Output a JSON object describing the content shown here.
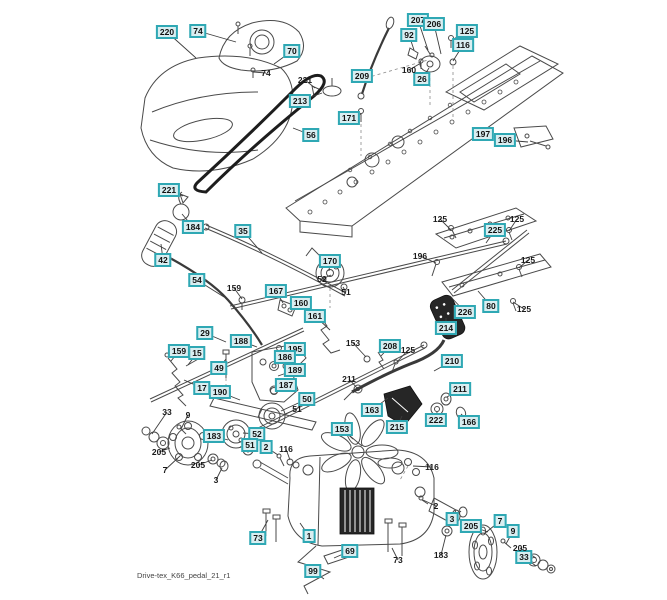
{
  "footer": {
    "filename": "Drive-tex_K66_pedal_21_r1"
  },
  "colors": {
    "callout_border": "#2fa8b4",
    "callout_fill": "#d9eef1",
    "leader_line": "#3d3d3d",
    "line_art": "#4a4a4a",
    "background": "#ffffff"
  },
  "callouts": [
    {
      "label": "220",
      "x": 167,
      "y": 32,
      "boxed": true,
      "tx": 196,
      "ty": 58
    },
    {
      "label": "74",
      "x": 198,
      "y": 31,
      "boxed": true,
      "tx": 236,
      "ty": 42
    },
    {
      "label": "70",
      "x": 292,
      "y": 51,
      "boxed": true,
      "tx": 274,
      "ty": 64
    },
    {
      "label": "213",
      "x": 300,
      "y": 101,
      "boxed": true,
      "tx": 322,
      "ty": 93
    },
    {
      "label": "207",
      "x": 418,
      "y": 20,
      "boxed": true,
      "tx": 428,
      "ty": 50
    },
    {
      "label": "206",
      "x": 434,
      "y": 24,
      "boxed": true,
      "tx": 441,
      "ty": 54
    },
    {
      "label": "92",
      "x": 409,
      "y": 35,
      "boxed": true,
      "tx": 414,
      "ty": 50
    },
    {
      "label": "125",
      "x": 467,
      "y": 31,
      "boxed": true,
      "tx": 452,
      "ty": 40
    },
    {
      "label": "116",
      "x": 463,
      "y": 45,
      "boxed": true,
      "tx": 453,
      "ty": 61
    },
    {
      "label": "209",
      "x": 362,
      "y": 76,
      "boxed": true,
      "tx": 370,
      "ty": 72
    },
    {
      "label": "26",
      "x": 422,
      "y": 79,
      "boxed": true,
      "tx": 429,
      "ty": 68
    },
    {
      "label": "171",
      "x": 349,
      "y": 118,
      "boxed": true,
      "tx": 361,
      "ty": 114
    },
    {
      "label": "56",
      "x": 311,
      "y": 135,
      "boxed": true,
      "tx": 293,
      "ty": 128
    },
    {
      "label": "197",
      "x": 483,
      "y": 134,
      "boxed": true,
      "tx": 514,
      "ty": 134
    },
    {
      "label": "196",
      "x": 505,
      "y": 140,
      "boxed": true,
      "tx": 528,
      "ty": 142
    },
    {
      "label": "221",
      "x": 169,
      "y": 190,
      "boxed": true,
      "tx": 183,
      "ty": 196
    },
    {
      "label": "184",
      "x": 193,
      "y": 227,
      "boxed": true,
      "tx": 182,
      "ty": 214
    },
    {
      "label": "35",
      "x": 243,
      "y": 231,
      "boxed": true,
      "tx": 262,
      "ty": 253
    },
    {
      "label": "42",
      "x": 163,
      "y": 260,
      "boxed": true,
      "tx": 161,
      "ty": 244
    },
    {
      "label": "54",
      "x": 197,
      "y": 280,
      "boxed": true,
      "tx": 224,
      "ty": 297
    },
    {
      "label": "167",
      "x": 276,
      "y": 291,
      "boxed": true,
      "tx": 283,
      "ty": 303
    },
    {
      "label": "160",
      "x": 301,
      "y": 303,
      "boxed": true,
      "tx": 315,
      "ty": 314
    },
    {
      "label": "161",
      "x": 315,
      "y": 316,
      "boxed": true,
      "tx": 330,
      "ty": 330
    },
    {
      "label": "170",
      "x": 330,
      "y": 261,
      "boxed": true,
      "tx": 329,
      "ty": 271
    },
    {
      "label": "225",
      "x": 495,
      "y": 230,
      "boxed": true,
      "tx": 486,
      "ty": 243
    },
    {
      "label": "80",
      "x": 491,
      "y": 306,
      "boxed": true,
      "tx": 478,
      "ty": 291
    },
    {
      "label": "226",
      "x": 465,
      "y": 312,
      "boxed": true,
      "tx": 450,
      "ty": 296
    },
    {
      "label": "29",
      "x": 205,
      "y": 333,
      "boxed": true,
      "tx": 226,
      "ty": 342
    },
    {
      "label": "188",
      "x": 241,
      "y": 341,
      "boxed": true,
      "tx": 257,
      "ty": 347
    },
    {
      "label": "195",
      "x": 295,
      "y": 349,
      "boxed": true,
      "tx": 281,
      "ty": 351
    },
    {
      "label": "186",
      "x": 285,
      "y": 357,
      "boxed": true,
      "tx": 276,
      "ty": 364
    },
    {
      "label": "189",
      "x": 295,
      "y": 370,
      "boxed": true,
      "tx": 278,
      "ty": 376
    },
    {
      "label": "187",
      "x": 286,
      "y": 385,
      "boxed": true,
      "tx": 276,
      "ty": 390
    },
    {
      "label": "49",
      "x": 219,
      "y": 368,
      "boxed": true,
      "tx": 226,
      "ty": 359
    },
    {
      "label": "190",
      "x": 220,
      "y": 392,
      "boxed": true,
      "tx": 240,
      "ty": 400
    },
    {
      "label": "17",
      "x": 202,
      "y": 388,
      "boxed": true,
      "tx": 184,
      "ty": 380
    },
    {
      "label": "15",
      "x": 197,
      "y": 353,
      "boxed": true,
      "tx": 188,
      "ty": 365
    },
    {
      "label": "159",
      "x": 179,
      "y": 351,
      "boxed": true,
      "tx": 171,
      "ty": 361
    },
    {
      "label": "50",
      "x": 307,
      "y": 399,
      "boxed": true,
      "tx": 281,
      "ty": 411
    },
    {
      "label": "208",
      "x": 390,
      "y": 346,
      "boxed": true,
      "tx": 381,
      "ty": 356
    },
    {
      "label": "214",
      "x": 446,
      "y": 328,
      "boxed": true,
      "tx": 446,
      "ty": 318
    },
    {
      "label": "210",
      "x": 452,
      "y": 361,
      "boxed": true,
      "tx": 434,
      "ty": 371
    },
    {
      "label": "211",
      "x": 460,
      "y": 389,
      "boxed": true,
      "tx": 447,
      "ty": 397
    },
    {
      "label": "222",
      "x": 436,
      "y": 420,
      "boxed": true,
      "tx": 437,
      "ty": 412
    },
    {
      "label": "166",
      "x": 469,
      "y": 422,
      "boxed": true,
      "tx": 461,
      "ty": 414
    },
    {
      "label": "163",
      "x": 372,
      "y": 410,
      "boxed": true,
      "tx": 388,
      "ty": 398
    },
    {
      "label": "215",
      "x": 397,
      "y": 427,
      "boxed": true,
      "tx": 402,
      "ty": 416
    },
    {
      "label": "153",
      "x": 342,
      "y": 429,
      "boxed": true,
      "tx": 353,
      "ty": 439
    },
    {
      "label": "183",
      "x": 214,
      "y": 436,
      "boxed": true,
      "tx": 228,
      "ty": 440
    },
    {
      "label": "52",
      "x": 257,
      "y": 434,
      "boxed": true,
      "tx": 243,
      "ty": 433
    },
    {
      "label": "51",
      "x": 250,
      "y": 445,
      "boxed": true,
      "tx": 240,
      "ty": 447
    },
    {
      "label": "2",
      "x": 266,
      "y": 447,
      "boxed": true,
      "tx": 278,
      "ty": 455
    },
    {
      "label": "73",
      "x": 258,
      "y": 538,
      "boxed": true,
      "tx": 268,
      "ty": 520
    },
    {
      "label": "1",
      "x": 309,
      "y": 536,
      "boxed": true,
      "tx": 300,
      "ty": 523
    },
    {
      "label": "69",
      "x": 350,
      "y": 551,
      "boxed": true,
      "tx": 334,
      "ty": 558
    },
    {
      "label": "99",
      "x": 313,
      "y": 571,
      "boxed": true,
      "tx": 324,
      "ty": 579
    },
    {
      "label": "3",
      "x": 452,
      "y": 519,
      "boxed": true,
      "tx": 461,
      "ty": 511
    },
    {
      "label": "205",
      "x": 471,
      "y": 526,
      "boxed": true,
      "tx": 488,
      "ty": 532
    },
    {
      "label": "7",
      "x": 500,
      "y": 521,
      "boxed": true,
      "tx": 484,
      "ty": 534
    },
    {
      "label": "9",
      "x": 513,
      "y": 531,
      "boxed": true,
      "tx": 506,
      "ty": 544
    },
    {
      "label": "33",
      "x": 524,
      "y": 557,
      "boxed": true,
      "tx": 536,
      "ty": 566
    },
    {
      "label": "74",
      "x": 266,
      "y": 73,
      "boxed": false,
      "tx": 253,
      "ty": 72
    },
    {
      "label": "221",
      "x": 305,
      "y": 80,
      "boxed": false,
      "tx": 315,
      "ty": 88
    },
    {
      "label": "160",
      "x": 409,
      "y": 70,
      "boxed": false,
      "tx": 421,
      "ty": 63
    },
    {
      "label": "125",
      "x": 440,
      "y": 219,
      "boxed": false,
      "tx": 451,
      "ty": 230
    },
    {
      "label": "125",
      "x": 517,
      "y": 219,
      "boxed": false,
      "tx": 509,
      "ty": 231
    },
    {
      "label": "125",
      "x": 528,
      "y": 260,
      "boxed": false,
      "tx": 519,
      "ty": 268
    },
    {
      "label": "125",
      "x": 524,
      "y": 309,
      "boxed": false,
      "tx": 513,
      "ty": 302
    },
    {
      "label": "196",
      "x": 420,
      "y": 256,
      "boxed": false,
      "tx": 436,
      "ty": 263
    },
    {
      "label": "52",
      "x": 322,
      "y": 279,
      "boxed": false,
      "tx": 331,
      "ty": 275
    },
    {
      "label": "51",
      "x": 346,
      "y": 292,
      "boxed": false,
      "tx": 343,
      "ty": 287
    },
    {
      "label": "159",
      "x": 234,
      "y": 288,
      "boxed": false,
      "tx": 242,
      "ty": 299
    },
    {
      "label": "153",
      "x": 353,
      "y": 343,
      "boxed": false,
      "tx": 366,
      "ty": 357
    },
    {
      "label": "125",
      "x": 408,
      "y": 350,
      "boxed": false,
      "tx": 397,
      "ty": 362
    },
    {
      "label": "211",
      "x": 349,
      "y": 379,
      "boxed": false,
      "tx": 357,
      "ty": 388
    },
    {
      "label": "51",
      "x": 297,
      "y": 409,
      "boxed": false,
      "tx": 285,
      "ty": 414
    },
    {
      "label": "33",
      "x": 167,
      "y": 412,
      "boxed": false,
      "tx": 152,
      "ty": 434
    },
    {
      "label": "9",
      "x": 188,
      "y": 415,
      "boxed": false,
      "tx": 181,
      "ty": 429
    },
    {
      "label": "205",
      "x": 159,
      "y": 452,
      "boxed": false,
      "tx": 170,
      "ty": 448
    },
    {
      "label": "205",
      "x": 198,
      "y": 465,
      "boxed": false,
      "tx": 212,
      "ty": 460
    },
    {
      "label": "7",
      "x": 165,
      "y": 470,
      "boxed": false,
      "tx": 180,
      "ty": 456
    },
    {
      "label": "3",
      "x": 216,
      "y": 480,
      "boxed": false,
      "tx": 222,
      "ty": 468
    },
    {
      "label": "116",
      "x": 286,
      "y": 449,
      "boxed": false,
      "tx": 290,
      "ty": 460
    },
    {
      "label": "116",
      "x": 432,
      "y": 467,
      "boxed": false,
      "tx": 413,
      "ty": 466
    },
    {
      "label": "2",
      "x": 436,
      "y": 506,
      "boxed": false,
      "tx": 423,
      "ty": 500
    },
    {
      "label": "183",
      "x": 441,
      "y": 555,
      "boxed": false,
      "tx": 446,
      "ty": 535
    },
    {
      "label": "73",
      "x": 398,
      "y": 560,
      "boxed": false,
      "tx": 392,
      "ty": 548
    },
    {
      "label": "205",
      "x": 520,
      "y": 548,
      "boxed": false,
      "tx": 536,
      "ty": 558
    }
  ]
}
